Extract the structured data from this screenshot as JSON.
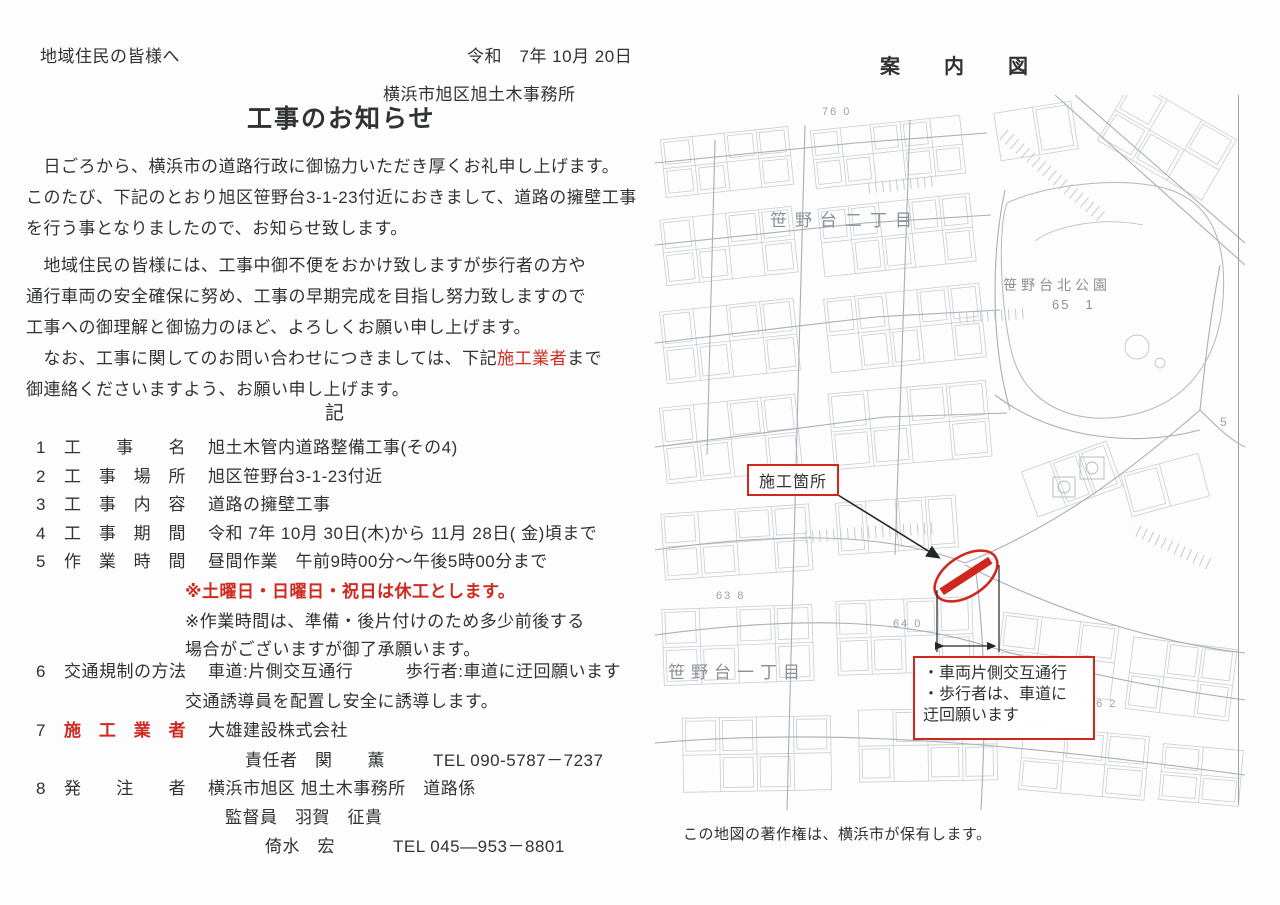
{
  "notice": {
    "addressee": "地域住民の皆様へ",
    "date": "令和　7年 10月 20日",
    "office": "横浜市旭区旭土木事務所",
    "title": "工事のお知らせ",
    "para1": "　日ごろから、横浜市の道路行政に御協力いただき厚くお礼申し上げます。",
    "para2": "このたび、下記のとおり旭区笹野台3-1-23付近におきまして、道路の擁壁工事",
    "para3": "を行う事となりましたので、お知らせ致します。",
    "para4": "　地域住民の皆様には、工事中御不便をおかけ致しますが歩行者の方や",
    "para5": "通行車両の安全確保に努め、工事の早期完成を目指し努力致しますので",
    "para6": "工事への御理解と御協力のほど、よろしくお願い申し上げます。",
    "para7_pre": "　なお、工事に関してのお問い合わせにつきましては、下記",
    "para7_red": "施工業者",
    "para7_post": "まで",
    "para8": "御連絡くださいますよう、お願い申し上げます。",
    "ki_heading": "記",
    "items": [
      {
        "no": "1",
        "label": "工　事　名",
        "value": "旭土木管内道路整備工事(その4)"
      },
      {
        "no": "2",
        "label": "工 事 場 所",
        "value": "旭区笹野台3-1-23付近"
      },
      {
        "no": "3",
        "label": "工 事 内 容",
        "value": "道路の擁壁工事"
      },
      {
        "no": "4",
        "label": "工 事 期 間",
        "value": "令和 7年 10月 30日(木)から 11月 28日( 金)頃まで"
      },
      {
        "no": "5",
        "label": "作 業 時 間",
        "value": "昼間作業　午前9時00分〜午後5時00分まで",
        "note_red": "※土曜日・日曜日・祝日は休工とします。",
        "note2": "※作業時間は、準備・後片付けのため多少前後する",
        "note3": "場合がございますが御了承願います。"
      },
      {
        "no": "6",
        "label": "交通規制の方法",
        "value": "車道:片側交互通行　　　歩行者:車道に迂回願います",
        "line2": "交通誘導員を配置し安全に誘導します。"
      },
      {
        "no": "7",
        "label": "施 工 業 者",
        "value": "大雄建設株式会社",
        "person": "責任者　関　　薫",
        "tel": "TEL 090-5787－7237"
      },
      {
        "no": "8",
        "label": "発　注　者",
        "value": "横浜市旭区 旭土木事務所　道路係",
        "line2": "監督員　羽賀　征貴",
        "line3": "倚水　宏",
        "tel": "TEL 045—953－8801"
      }
    ]
  },
  "map": {
    "title": "案　内　図",
    "district2": "笹野台二丁目",
    "district1": "笹野台一丁目",
    "park_name": "笹野台北公園",
    "park_no": "65　1",
    "elev76": "76 0",
    "elev63": "63 8",
    "elev64": "64 0",
    "elev66": "66 2",
    "edge5": "5",
    "construction_label": "施工箇所",
    "callout1": "・車両片側交互通行",
    "callout2": "・歩行者は、車道に",
    "callout3": "迂回願います",
    "copyright": "この地図の著作権は、横浜市が保有します。"
  },
  "colors": {
    "accent_red": "#d02a20",
    "map_line": "#b0b5bc"
  }
}
